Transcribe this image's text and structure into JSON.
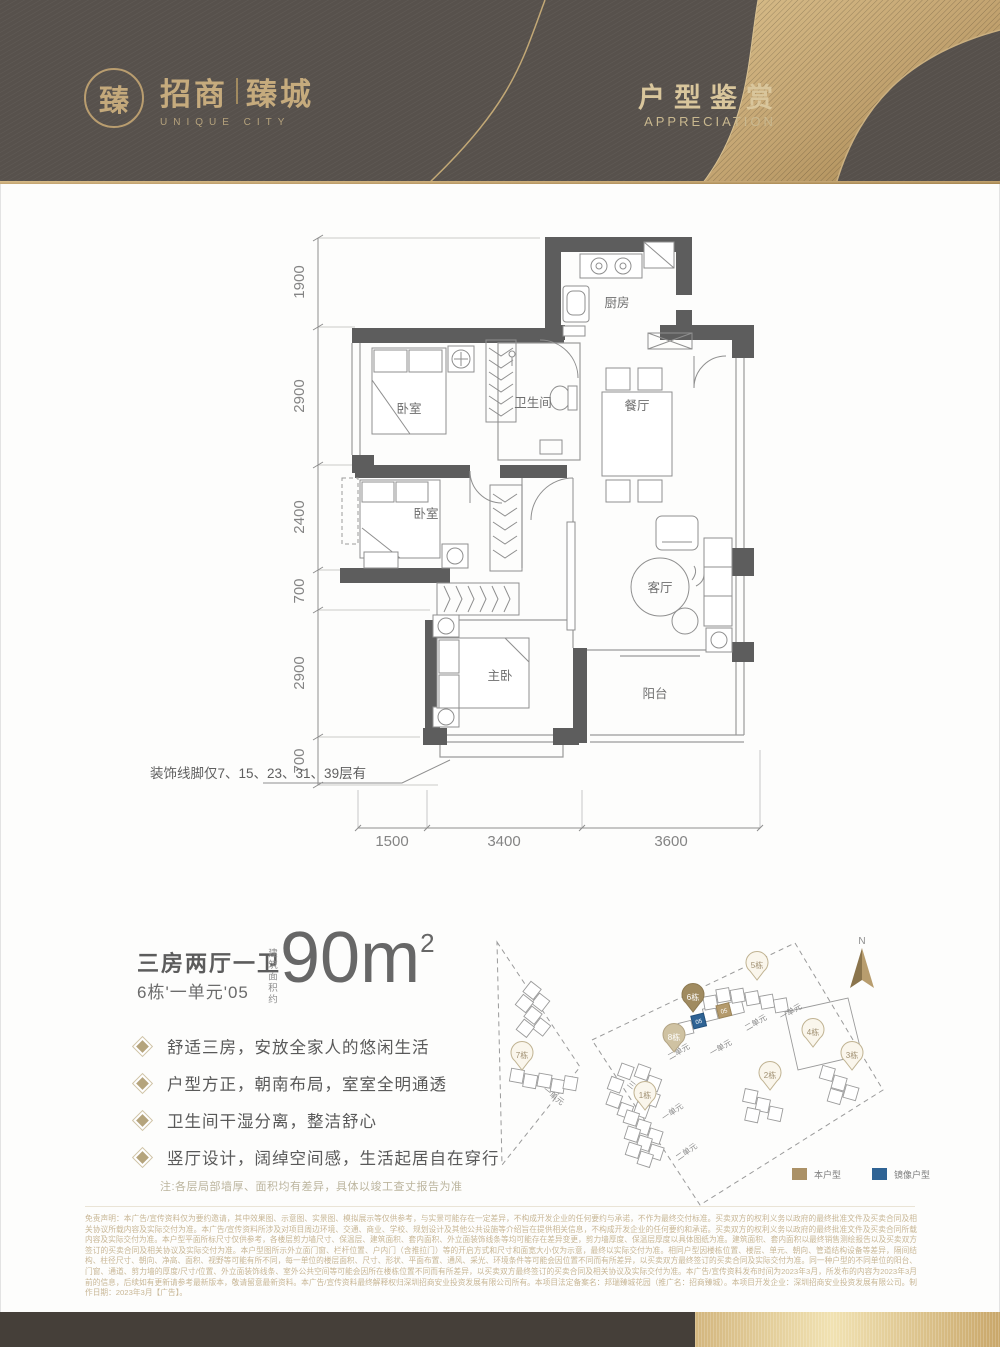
{
  "header": {
    "seal_char": "臻",
    "brand_cn_left": "招商",
    "brand_cn_right": "臻城",
    "brand_en": "UNIQUE CITY",
    "title": "户型鉴赏",
    "subtitle": "APPRECIATION",
    "colors": {
      "bg": "#57514c",
      "gold": "#c2a876"
    }
  },
  "floorplan": {
    "rooms": {
      "kitchen": "厨房",
      "bedroom1": "卧室",
      "bath": "卫生间",
      "dining": "餐厅",
      "bedroom2": "卧室",
      "living": "客厅",
      "master": "主卧",
      "balcony": "阳台"
    },
    "dims_left": [
      "1900",
      "2900",
      "2400",
      "700",
      "2900",
      "700"
    ],
    "dims_bottom": [
      "1500",
      "3400",
      "3600"
    ],
    "molding_note": "装饰线脚仅7、15、23、31、39层有"
  },
  "unit": {
    "layout_title": "三房两厅一卫",
    "unit_no": "6栋'一单元'05",
    "area_label": "建筑面积约",
    "area_value": "90m",
    "area_exp": "2",
    "features": [
      "舒适三房，安放全家人的悠闲生活",
      "户型方正，朝南布局，室室全明通透",
      "卫生间干湿分离，整洁舒心",
      "竖厅设计，阔绰空间感，生活起居自在穿行"
    ],
    "note": "注:各层局部墙厚、面积均有差异，具体以竣工查丈报告为准"
  },
  "siteplan": {
    "compass": "N",
    "pins": {
      "b1": "1栋",
      "b2": "2栋",
      "b3": "3栋",
      "b4": "4栋",
      "b5": "5栋",
      "b6": "6栋",
      "b7": "7栋",
      "b8": "8栋"
    },
    "unit_labels": {
      "u1": "一单元",
      "u2": "二单元",
      "u3": "三单元"
    },
    "mirror_unit": "05",
    "this_unit": "05",
    "legend": {
      "this_type": "本户型",
      "mirror_type": "镜像户型",
      "this_color": "#ab9166",
      "mirror_color": "#2f6394"
    }
  },
  "disclaimer": "免责声明：本广告/宣传资料仅为要约邀请，其中效果图、示意图、实景图、模拟展示等仅供参考，与实景可能存在一定差异，不构成开发企业的任何要约与承诺，不作为最终交付标准。买卖双方的权利义务以政府的最终批准文件及买卖合同及相关协议所载内容及实际交付为准。本广告/宣传资料所涉及对项目周边环境、交通、商业、学校、规划设计及其他公共设施等介绍旨在提供相关信息，不构成开发企业的任何要约和承诺。买卖双方的权利义务以政府的最终批准文件及买卖合同所载内容及实际交付为准。本户型平面所标尺寸仅供参考，各楼层剪力墙尺寸、保温层、建筑面积、套内面积、外立面装饰线条等均可能存在差异变更，剪力墙厚度、保温层厚度以具体图纸为准。建筑面积、套内面积以最终销售测绘报告以及买卖双方签订的买卖合同及相关协议及实际交付为准。本户型图所示外立面门窗、栏杆位置、户内门（含推拉门）等的开启方式和尺寸和面宽大小仅为示意，最终以实际交付为准。相同户型因楼栋位置、楼层、单元、朝向、管道结构设备等差异，隔间结构、柱径尺寸、朝向、净高、面积、视野等可能有所不同，每一单位的楼层面积、尺寸、形状、平面布置、通风、采光、环境条件等可能会因位置不同而有所差异，以买卖双方最终签订的买卖合同及实际交付为准。同一种户型的不同单位的阳台、门窗、通道、剪力墙的厚度/尺寸/位置、外立面装饰线条、室外公共空间等可能会因所在楼栋位置不同而有所差异，以买卖双方最终签订的买卖合同及相关协议及实际交付为准。本广告/宣传资料发布时间为2023年3月，所发布的内容为2023年3月前的信息，后续如有更新请参考最新版本，敬请留意最新资料。本广告/宣传资料最终解释权归深圳招商安业投资发展有限公司所有。本项目法定备案名：邦瑞臻城花园（推广名：招商臻城）。本项目开发企业：深圳招商安业投资发展有限公司。制作日期：2023年3月【广告】。"
}
